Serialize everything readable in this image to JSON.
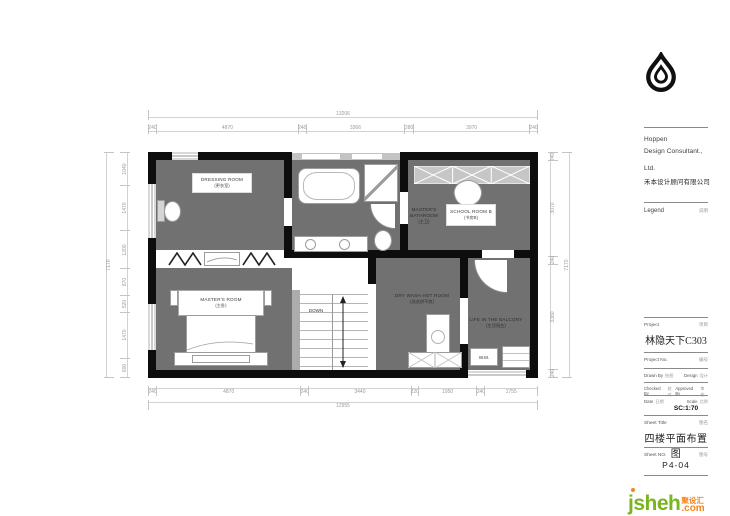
{
  "title_block": {
    "company": {
      "line1": "Hoppen",
      "line2": "Design Consultant.,",
      "line3": "Ltd.",
      "cn": "禾本设计顾问有限公司"
    },
    "legend": {
      "en": "Legend",
      "cn": "说明"
    },
    "project": {
      "en": "Project",
      "cn": "项目",
      "value": "林隐天下C303"
    },
    "project_no": {
      "en": "Project  No.",
      "cn": "编号"
    },
    "drawn_by": {
      "en": "Drawn By",
      "cn": "绘图"
    },
    "design": {
      "en": "Design",
      "cn": "设计"
    },
    "checked_by": {
      "en": "Checked By",
      "cn": "校对"
    },
    "approved_by": {
      "en": "Approved By",
      "cn": "审核"
    },
    "date": {
      "en": "Date",
      "cn": "日期"
    },
    "scale": {
      "en": "Scale",
      "cn": "比例",
      "value": "SC:1:70"
    },
    "sheet_title": {
      "en": "Sheet  Title",
      "cn": "图名",
      "value": "四楼平面布置图"
    },
    "sheet_no": {
      "en": "Sheet  NO.",
      "cn": "图号",
      "value": "P4-04"
    }
  },
  "plan": {
    "rooms": {
      "dressing": {
        "en": "DRESSING  ROOM",
        "cn": "(更衣室)"
      },
      "masters_bath": {
        "l1": "MASTER'S",
        "l2": "BATHROOM",
        "cn": "(主卫)"
      },
      "school": {
        "en": "SCHOOL ROOM B",
        "cn": "(书房B)"
      },
      "master": {
        "en": "MASTER'S  ROOM",
        "cn": "(主卧)"
      },
      "drywash": {
        "en": "DRY WASH HOT ROOM",
        "cn": "(洗衣烘干房)"
      },
      "balcony": {
        "en": "LIFE IN THE BALCONY",
        "cn": "(生活阳台)"
      }
    },
    "stairs": {
      "label": "DOWN"
    },
    "appliance": {
      "label": "W.M."
    },
    "dims": {
      "top_total": "13206",
      "top": [
        "240",
        "4870",
        "240",
        "3366",
        "280",
        "3970",
        "240"
      ],
      "bottom": [
        "240",
        "4870",
        "240",
        "3440",
        "220",
        "1950",
        "240",
        "1755"
      ],
      "bottom_total": "12955",
      "left": [
        "1040",
        "1470",
        "1200",
        "870",
        "520",
        "1470",
        "600"
      ],
      "left_total": "7170",
      "right": [
        "240",
        "3070",
        "240",
        "3380",
        "240"
      ],
      "right_total": "7170"
    }
  },
  "watermark": {
    "name": "jsheh",
    "cn": "聚设汇",
    "tld": ".com"
  },
  "colors": {
    "room_fill": "#717171",
    "wall": "#0d0d0d",
    "accent_green": "#7ab51d",
    "accent_orange": "#f5851f"
  }
}
